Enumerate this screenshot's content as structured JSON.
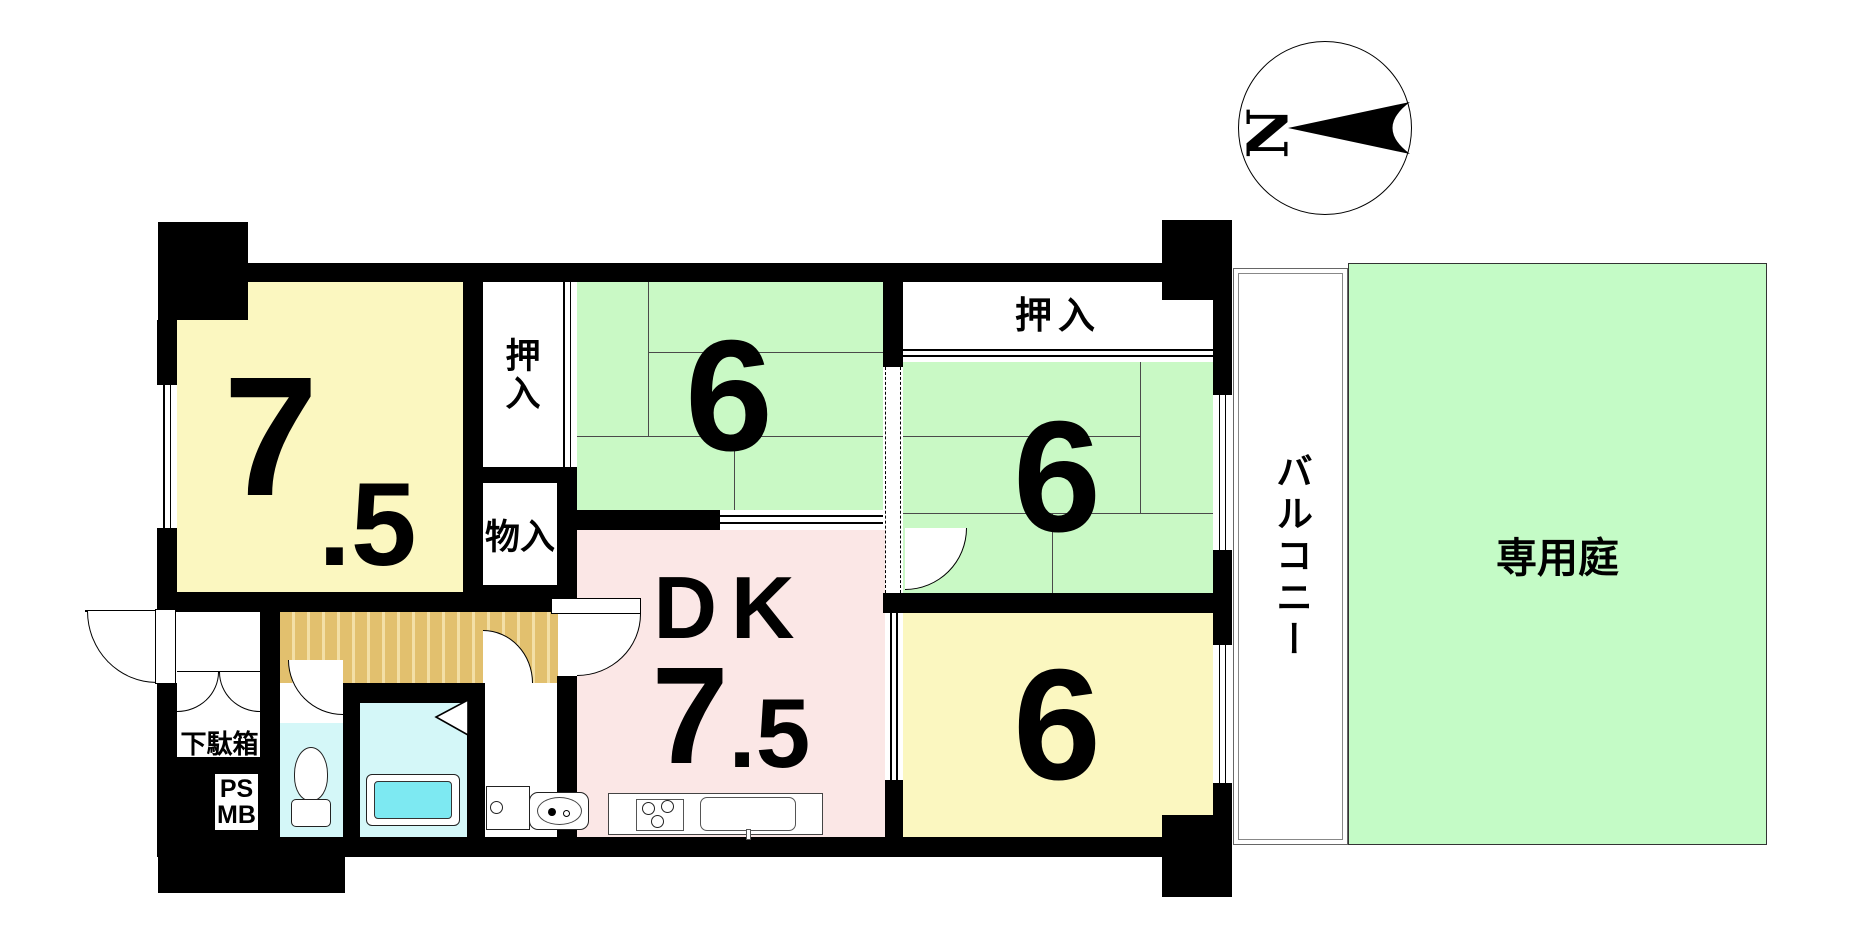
{
  "title": "マンション間取り図 (floor plan)",
  "colors": {
    "wall": "#000000",
    "room_yellow": "#FBF7C0",
    "room_green": "#C9F9C5",
    "room_pink": "#FBE7E6",
    "water_cyan": "#D4F7F8",
    "bathtub_cyan": "#7DE9F2",
    "genkan_tan": "#E2C06E",
    "genkan_stripe": "#F3DFA6",
    "garden_green": "#C4FBC6"
  },
  "compass": {
    "north_label": "N"
  },
  "rooms": {
    "western_75": {
      "label_main": "7",
      "label_frac": ".5"
    },
    "tatami_top": {
      "label": "6"
    },
    "tatami_right": {
      "label": "6"
    },
    "bedroom_bottom": {
      "label": "6"
    },
    "dk": {
      "name": "DK",
      "size_main": "7",
      "size_frac": ".5"
    }
  },
  "closets": {
    "oshiire_left": "押入",
    "oshiire_right": "押入",
    "monoire": "物入",
    "shoe_cabinet": "下駄箱"
  },
  "outdoor": {
    "balcony": "バルコニー",
    "private_garden": "専用庭"
  },
  "utility": {
    "ps": "PS",
    "mb": "MB"
  }
}
